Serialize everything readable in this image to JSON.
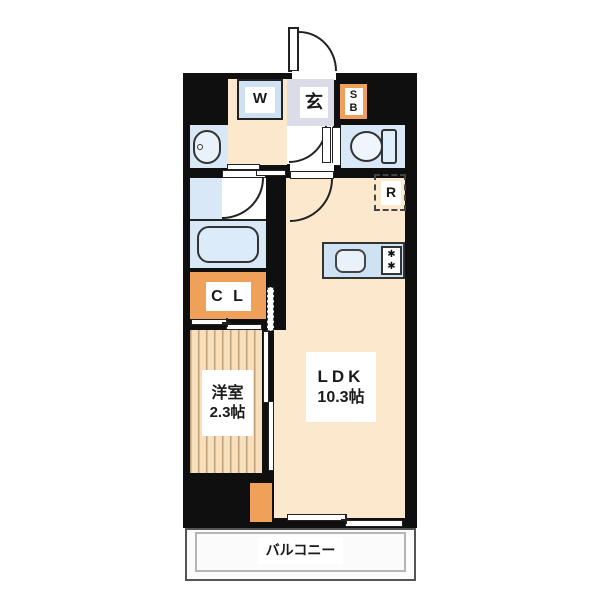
{
  "plan": {
    "rooms": {
      "ldk": {
        "label": "LDK",
        "size": "10.3帖"
      },
      "western_room": {
        "label": "洋室",
        "size": "2.3帖"
      },
      "entrance": {
        "label": "玄"
      },
      "closet": {
        "label": "C L"
      },
      "balcony": {
        "label": "バルコニー"
      }
    },
    "fixtures": {
      "washer": {
        "label": "W"
      },
      "shoe_box": {
        "line1": "S",
        "line2": "B"
      },
      "refrigerator": {
        "label": "R"
      }
    },
    "icons": {
      "stove_burner": "✱"
    },
    "colors": {
      "wall": "#0f0f0f",
      "floor_cream": "#fce8cc",
      "floor_wood": "#f7debc",
      "wood_line": "#bfa077",
      "water_blue": "#d9e8f7",
      "counter_blue": "#cfe2f4",
      "genkan_gray": "#dcdce8",
      "accent_orange": "#f0a159",
      "balcony_floor": "#fbfbfb"
    }
  }
}
